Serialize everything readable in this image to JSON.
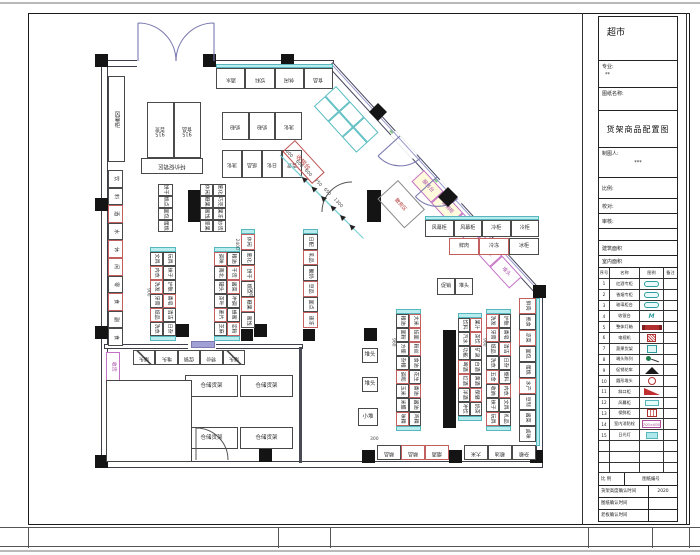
{
  "sheet": {
    "project_title": "超市",
    "drawing_title": "货架商品配置图"
  },
  "title_block": {
    "project": "超市",
    "field_major_label": "专业:",
    "field_major_value": "**",
    "field_name_label": "图纸名称:",
    "drawing_name": "货架商品配置图",
    "drafter_label": "制图人:",
    "drafter_value": "***",
    "rows": [
      {
        "label": "比例:"
      },
      {
        "label": "校对:"
      },
      {
        "label": "审核:"
      },
      {
        "label": ""
      },
      {
        "label": "建筑面积"
      },
      {
        "label": "室内面积"
      }
    ],
    "legend": {
      "headers": [
        "序号",
        "名称",
        "图例",
        "备注"
      ],
      "rows": [
        {
          "no": "1",
          "name": "红酒专柜",
          "sym": "teal-pill",
          "note": ""
        },
        {
          "no": "2",
          "name": "香烟专柜",
          "sym": "teal-pill",
          "note": ""
        },
        {
          "no": "3",
          "name": "玻璃柜台",
          "sym": "teal-pill",
          "note": ""
        },
        {
          "no": "4",
          "name": "收银台",
          "sym": "mm",
          "note": ""
        },
        {
          "no": "5",
          "name": "整体灯箱",
          "sym": "red-bar",
          "note": ""
        },
        {
          "no": "6",
          "name": "电视机",
          "sym": "red-hatch",
          "note": ""
        },
        {
          "no": "7",
          "name": "蔬果货架",
          "sym": "teal-sq",
          "note": ""
        },
        {
          "no": "8",
          "name": "端头陈列",
          "sym": "dot-line",
          "note": ""
        },
        {
          "no": "9",
          "name": "促销花车",
          "sym": "tri",
          "note": ""
        },
        {
          "no": "10",
          "name": "圆形堆头",
          "sym": "red-circle",
          "note": ""
        },
        {
          "no": "11",
          "name": "斜口柜",
          "sym": "red-flag",
          "note": ""
        },
        {
          "no": "12",
          "name": "风幕柜",
          "sym": "cyan-tag",
          "note": ""
        },
        {
          "no": "13",
          "name": "保鲜柜",
          "sym": "red-box",
          "note": ""
        },
        {
          "no": "14",
          "name": "室内消防栓",
          "sym": "magenta-box",
          "sym_text": "700×600",
          "note": ""
        },
        {
          "no": "15",
          "name": "日光灯",
          "sym": "cyan-box",
          "note": ""
        },
        {
          "no": "",
          "name": "",
          "sym": "",
          "note": ""
        },
        {
          "no": "",
          "name": "",
          "sym": "",
          "note": ""
        },
        {
          "no": "",
          "name": "",
          "sym": "",
          "note": ""
        }
      ]
    },
    "footer_rows": [
      {
        "a": "比 例",
        "b": "图纸编号"
      },
      {
        "a": "货架高度确认时间",
        "b": "2020"
      },
      {
        "a": "图纸确认时间",
        "b": ""
      },
      {
        "a": "老板确认时间",
        "b": ""
      }
    ]
  },
  "plan": {
    "wall_band_top": [
      "酒水",
      "饮料",
      "休闲",
      "食品"
    ],
    "block915_a": "915|百货",
    "block915_b": "915|食品",
    "block915_c": "特价促销区",
    "blockB_r1": [
      "奶粉",
      "奶粉",
      "洗化"
    ],
    "blockB_r2": [
      "洗化",
      "纸品",
      "日化",
      "百货"
    ],
    "left_tall": "风幕柜",
    "left_wall_cells": [
      "饮",
      "料",
      "!酒",
      "水",
      "!休",
      "!闲",
      "零",
      "!食",
      "副",
      "食"
    ],
    "receive_cell": "收货",
    "fire_cell": "!消防",
    "checkout_label": "收银台",
    "checkout_dims": [
      "600",
      "600",
      "600",
      "750",
      "650",
      "1300"
    ],
    "diag_dim": "1000",
    "diag_cells": [
      "^服务台",
      "^促销柜",
      "散称区",
      "糖果柜",
      "堆头"
    ],
    "diag_booth": "散货区",
    "gu1": [
      "饼干",
      "糕点",
      "面包",
      "蛋糕"
    ],
    "gu2": [
      "休闲",
      "膨化",
      "糖果",
      "巧克",
      "蜜饯",
      "果冻",
      "坚果",
      "炒货"
    ],
    "g1": [
      "文具",
      "玩具",
      "!内衣",
      "袜子",
      "!洗发",
      "护肤",
      "牙膏",
      "!香皂",
      "!纸品",
      "清洁",
      "洗衣",
      "日杂"
    ],
    "g2": [
      "!调味",
      "粮油",
      "南北",
      "!干货",
      "罐头",
      "!酱菜",
      "茶叶",
      "冲调",
      "!麦片",
      "蜂蜜",
      "芝麻",
      "!淀粉"
    ],
    "g3": [
      "!休闲",
      "膨化",
      "!饼干",
      "糕点",
      "!糖果",
      "蜜饯"
    ],
    "g4": [
      "日配",
      "!乳品",
      "酸奶",
      "!豆品",
      "面点",
      "!速冻"
    ],
    "g5": [
      "粮油",
      "!大米",
      "面粉",
      "!挂面",
      "方便",
      "!粉丝",
      "杂粮",
      "食油",
      "!调和",
      "花生",
      "玉米",
      "!香油",
      "米醋",
      "酱油",
      "!味精",
      "鸡精"
    ],
    "g6": [
      "饮料",
      "!果汁",
      "汽水",
      "!茶饮",
      "功能",
      "矿泉",
      "!啤酒",
      "白酒",
      "!红酒",
      "黄酒",
      "洋酒",
      "!保健",
      "冲饮",
      "奶茶"
    ],
    "g7": [
      "!洗发",
      "护肤",
      "!牙膏",
      "香皂",
      "纸品",
      "!清洁",
      "洗衣",
      "日杂",
      "!五金",
      "塑料",
      "收纳",
      "!内衣",
      "袜子",
      "文具",
      "!玩具",
      "礼品"
    ],
    "right_wall_cells": [
      "!鲜肉",
      "熟食",
      "!凉菜",
      "面包",
      "蛋糕",
      "!水产",
      "豆制",
      "酱菜",
      "卤味"
    ],
    "freezer_r1": [
      "风幕柜",
      "风幕柜",
      "冷柜",
      "冷柜"
    ],
    "freezer_r2": [
      "!鲜肉",
      "!冷冻",
      "冰柜"
    ],
    "pair_cells": [
      "促销",
      "堆头"
    ],
    "endcap_row": [
      "端头",
      "堆头",
      "促销",
      "特价",
      "端头"
    ],
    "pallet_1": "堆头",
    "pallet_2": "堆头",
    "pallet_3": "小堆",
    "bottom_r1": [
      "精品",
      "!精品",
      "!烟酒"
    ],
    "bottom_r2": [
      "大米",
      "粮油",
      "杂粮"
    ],
    "storage_1": "仓储货架",
    "storage_2": "仓储货架",
    "storage_3": "仓储货架",
    "storage_4": "仓储货架",
    "dims_side": [
      "900",
      "900",
      "2400",
      "960",
      "960",
      "300"
    ]
  }
}
